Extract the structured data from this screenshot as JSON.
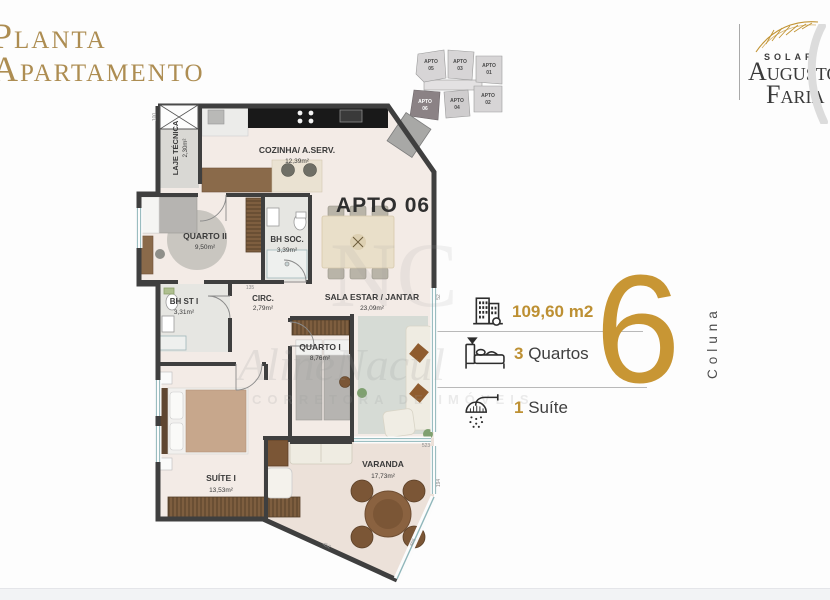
{
  "title": {
    "line1": "Planta",
    "line2": "Apartamento"
  },
  "logo": {
    "brand": "SOLAR",
    "name_top": "Augusto",
    "name_bottom": "Faria"
  },
  "key_plan": {
    "units": [
      {
        "l1": "APTO",
        "l2": "05",
        "highlighted": false
      },
      {
        "l1": "APTO",
        "l2": "03",
        "highlighted": false
      },
      {
        "l1": "APTO",
        "l2": "01",
        "highlighted": false
      },
      {
        "l1": "APTO",
        "l2": "06",
        "highlighted": true
      },
      {
        "l1": "APTO",
        "l2": "04",
        "highlighted": false
      },
      {
        "l1": "APTO",
        "l2": "02",
        "highlighted": false
      }
    ]
  },
  "apto_label": "APTO 06",
  "rooms": {
    "laje": {
      "name": "LAJE TÉCNICA",
      "area": "2,30m²"
    },
    "cozinha": {
      "name": "COZINHA/ A.SERV.",
      "area": "12,39m²"
    },
    "quarto2": {
      "name": "QUARTO II",
      "area": "9,50m²"
    },
    "bhsoc": {
      "name": "BH SOC.",
      "area": "3,39m²"
    },
    "bhst1": {
      "name": "BH ST I",
      "area": "3,31m²"
    },
    "circ": {
      "name": "CIRC.",
      "area": "2,79m²"
    },
    "sala": {
      "name": "SALA ESTAR / JANTAR",
      "area": "23,09m²"
    },
    "quarto1": {
      "name": "QUARTO I",
      "area": "8,76m²"
    },
    "suite1": {
      "name": "SUÍTE I",
      "area": "13,53m²"
    },
    "varanda": {
      "name": "VARANDA",
      "area": "17,73m²"
    }
  },
  "dims": {
    "d100": "100",
    "d52": "52",
    "d135": "135",
    "d523": "523",
    "d194": "194",
    "d452": "452",
    "d465": "465"
  },
  "info": {
    "area_value": "109,60 m2",
    "quartos_num": "3",
    "quartos_label": "Quartos",
    "suite_num": "1",
    "suite_label": "Suíte"
  },
  "column": {
    "number": "6",
    "label": "Coluna"
  },
  "watermark": {
    "initials": "NC",
    "name": "AlineNacul",
    "subtitle": "CORRETORA DE IMÓVEIS"
  },
  "colors": {
    "gold": "#bd9033",
    "gold_big": "#c89634",
    "title_gold": "#ad8d52",
    "wall": "#3f3f3f",
    "highlight_unit": "#8b8285"
  }
}
